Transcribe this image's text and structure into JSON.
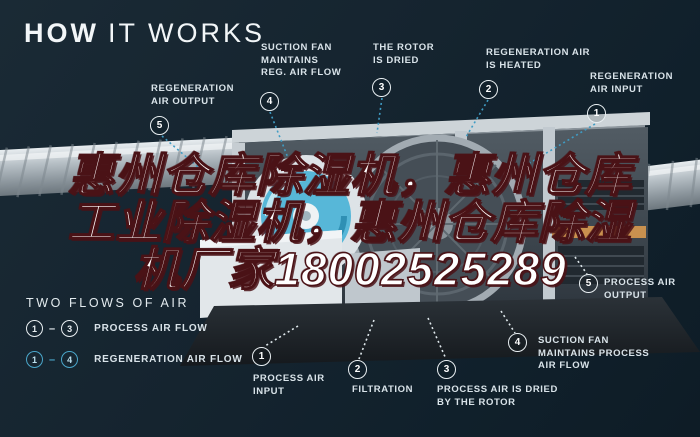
{
  "title": {
    "bold": "HOW",
    "light": "IT WORKS"
  },
  "overlay": {
    "line1": "惠州仓库除湿机，惠州仓库",
    "line2": "工业除湿机，惠州仓库除湿",
    "line3": "机厂家18002525289"
  },
  "callouts": {
    "reg_air_output": {
      "num": "5",
      "label": "REGENERATION\nAIR OUTPUT"
    },
    "suction_fan_reg": {
      "num": "4",
      "label": "SUCTION FAN\nMAINTAINS\nREG. AIR FLOW"
    },
    "rotor_dried": {
      "num": "3",
      "label": "THE ROTOR\nIS DRIED"
    },
    "reg_air_heated": {
      "num": "2",
      "label": "REGENERATION AIR\nIS HEATED"
    },
    "reg_air_input": {
      "num": "1",
      "label": "REGENERATION\nAIR INPUT"
    },
    "process_air_input": {
      "num": "1",
      "label": "PROCESS AIR\nINPUT"
    },
    "filtration": {
      "num": "2",
      "label": "FILTRATION"
    },
    "process_air_dried": {
      "num": "3",
      "label": "PROCESS AIR IS DRIED\nBY THE ROTOR"
    },
    "suction_fan_process": {
      "num": "4",
      "label": "SUCTION FAN\nMAINTAINS PROCESS\nAIR FLOW"
    },
    "process_air_output": {
      "num": "5",
      "label": "PROCESS AIR\nOUTPUT"
    }
  },
  "legend": {
    "title": "TWO FLOWS OF AIR",
    "separator": "–",
    "rows": [
      {
        "from": "1",
        "to": "3",
        "label": "PROCESS AIR FLOW"
      },
      {
        "from": "1",
        "to": "4",
        "label": "REGENERATION AIR FLOW"
      }
    ]
  },
  "colors": {
    "background": "#15232e",
    "accent_blue": "#3f9cc4",
    "label_text": "#d9e3e9",
    "overlay_fill": "#ffffff",
    "overlay_outline": "#4a1216",
    "fan_blue": "#57b7d8",
    "tray_orange": "#c9914f"
  }
}
